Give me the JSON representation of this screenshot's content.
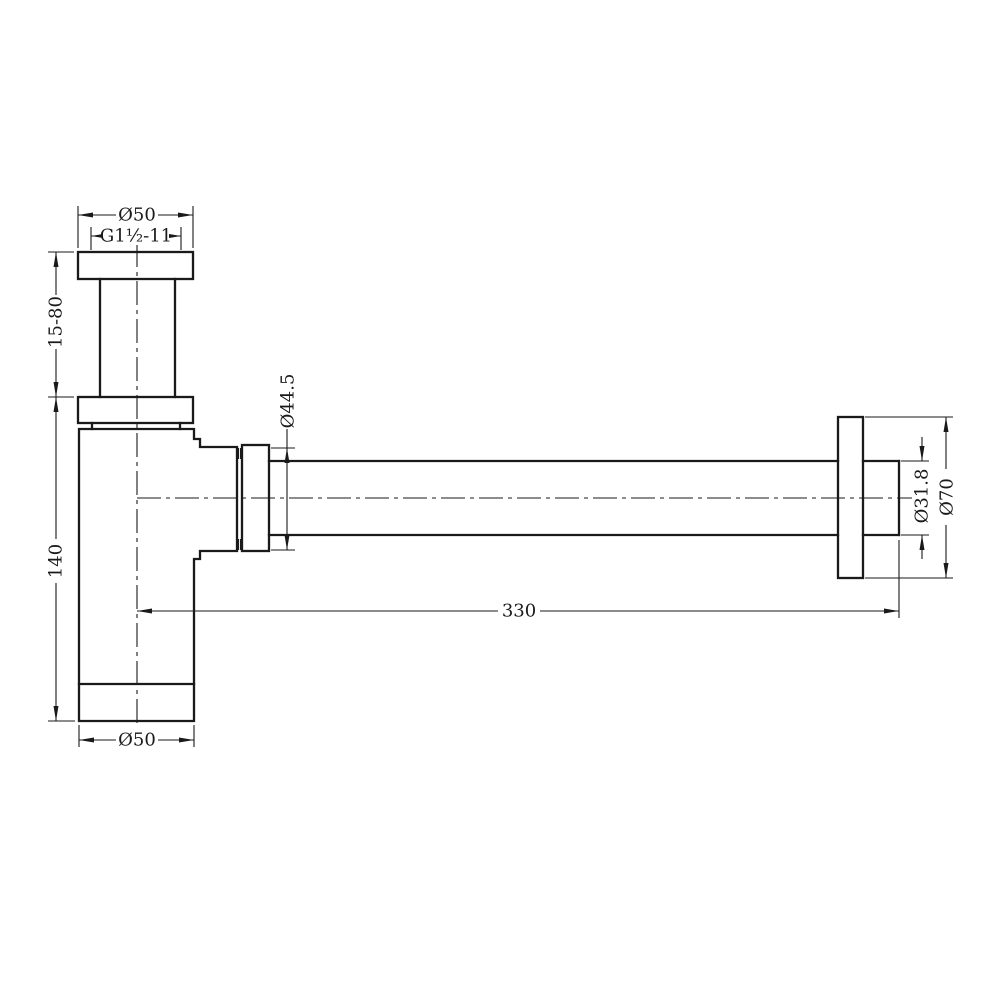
{
  "drawing": {
    "type": "technical-drawing",
    "subject": "bottle-trap-with-wall-outlet",
    "colors": {
      "background": "#ffffff",
      "line": "#1a1a1a"
    },
    "labels": {
      "top_diameter": "Ø50",
      "thread_spec": "G1½-11",
      "inlet_height_range": "15-80",
      "body_height": "140",
      "nut_diameter": "Ø44.5",
      "overall_length": "330",
      "outlet_pipe_diameter": "Ø31.8",
      "wall_flange_diameter": "Ø70",
      "bottom_diameter": "Ø50"
    }
  }
}
